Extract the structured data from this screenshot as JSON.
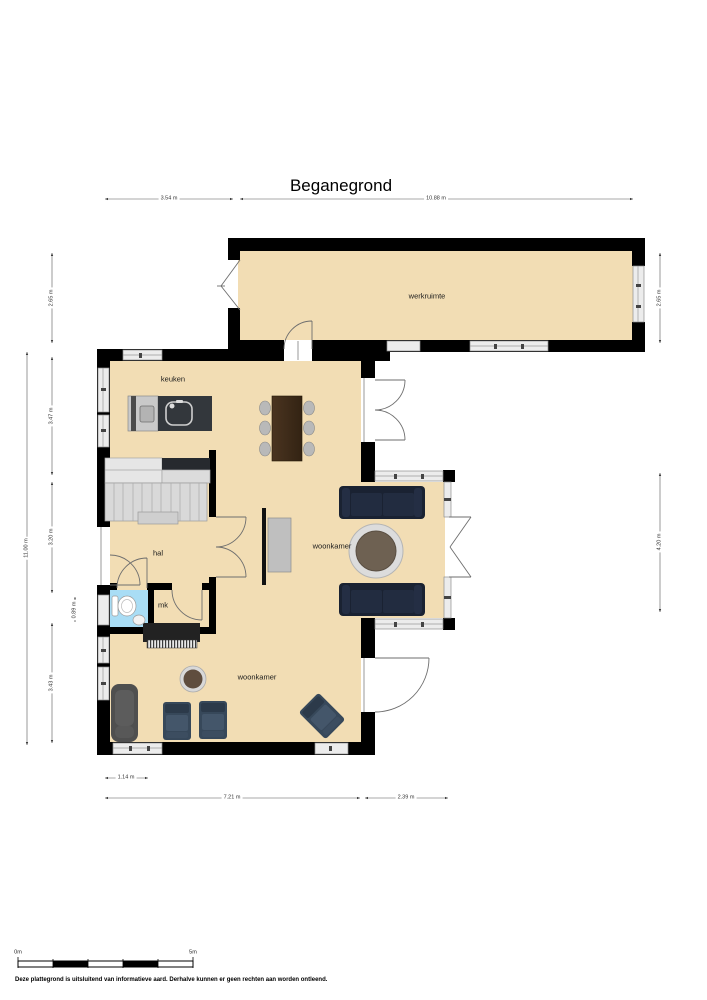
{
  "title": "Beganegrond",
  "rooms": {
    "werkruimte": "werkruimte",
    "keuken": "keuken",
    "hal": "hal",
    "mk": "mk",
    "woonkamer_upper": "woonkamer",
    "woonkamer_lower": "woonkamer"
  },
  "dimensions": {
    "top_left": "3.54 m",
    "top_right": "10.88 m",
    "left_outer": "11.00 m",
    "left_werkruimte": "2.65 m",
    "left_keuken": "3.47 m",
    "left_hal": "3.20 m",
    "left_toilet": "0.89 m",
    "left_woonkamer": "3.43 m",
    "right_werkruimte": "2.65 m",
    "right_wing": "4.20 m",
    "bottom_small": "1.14 m",
    "bottom_left": "7.21 m",
    "bottom_right": "2.39 m"
  },
  "scale_bar": {
    "start_label": "0m",
    "end_label": "5m"
  },
  "footer": "Deze plattegrond is uitsluitend van informatieve aard. Derhalve kunnen er geen rechten aan worden ontleend.",
  "colors": {
    "floor": "#f2ddb4",
    "wall": "#000000",
    "toilet_floor": "#a9ddf5",
    "sofa": "#1a2232",
    "window": "#ececec"
  }
}
